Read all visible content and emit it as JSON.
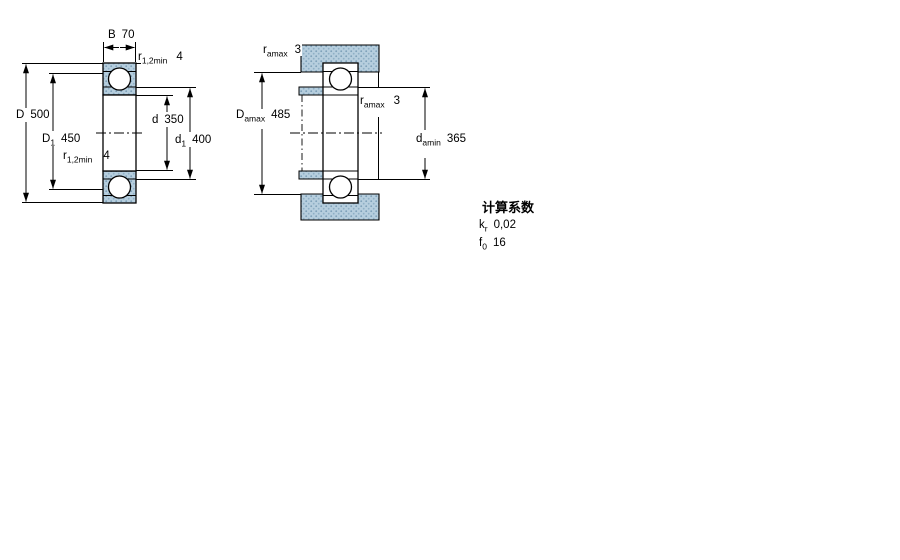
{
  "drawing": {
    "left_view": {
      "description": "bearing cross section with boundary dimensions",
      "labels": {
        "B": {
          "symbol": "B",
          "subscript": "",
          "value": "70"
        },
        "r_top": {
          "symbol": "r",
          "subscript": "1,2min",
          "value": "4"
        },
        "r_bottom": {
          "symbol": "r",
          "subscript": "1,2min",
          "value": "4"
        },
        "D": {
          "symbol": "D",
          "subscript": "",
          "value": "500"
        },
        "D1": {
          "symbol": "D",
          "subscript": "1",
          "value": "450"
        },
        "d": {
          "symbol": "d",
          "subscript": "",
          "value": "350"
        },
        "d1": {
          "symbol": "d",
          "subscript": "1",
          "value": "400"
        }
      }
    },
    "right_view": {
      "description": "bearing mounted with shaft and housing abutment dimensions",
      "labels": {
        "ra_top": {
          "symbol": "r",
          "subscript": "amax",
          "value": "3"
        },
        "Da": {
          "symbol": "D",
          "subscript": "amax",
          "value": "485"
        },
        "ra_mid": {
          "symbol": "r",
          "subscript": "amax",
          "value": "3"
        },
        "da": {
          "symbol": "d",
          "subscript": "amin",
          "value": "365"
        }
      }
    },
    "calculation_factors": {
      "title": "计算系数",
      "rows": [
        {
          "symbol": "k",
          "subscript": "r",
          "value": "0,02"
        },
        {
          "symbol": "f",
          "subscript": "0",
          "value": "16"
        }
      ]
    },
    "colors": {
      "hatch_fill": "#b6cede",
      "hatch_dot": "#7c9fb8",
      "hatch_dot2": "#8fb0c6",
      "line": "#000000"
    }
  }
}
